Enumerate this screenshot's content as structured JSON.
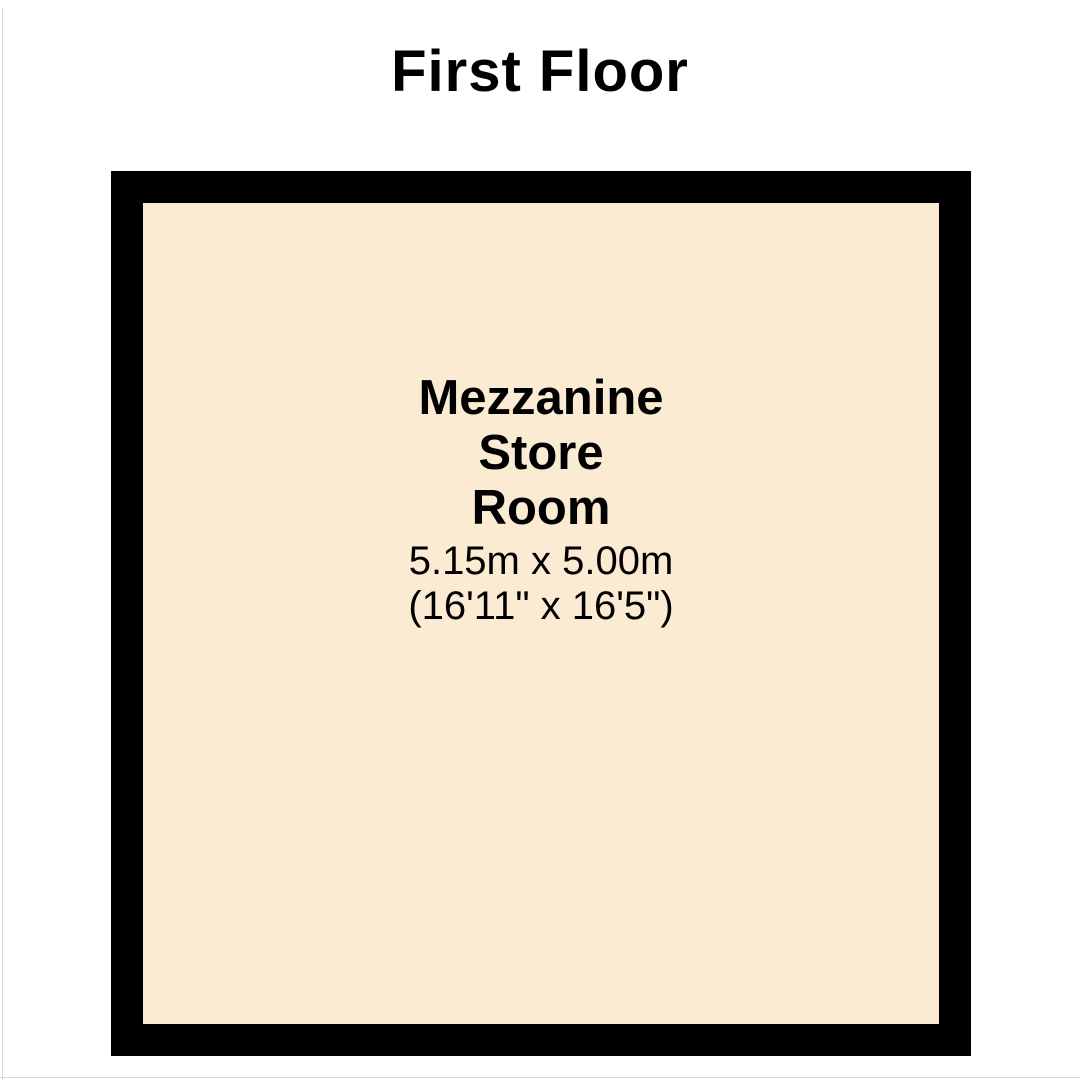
{
  "page": {
    "title": "First Floor"
  },
  "floorplan": {
    "room": {
      "name_line1": "Mezzanine",
      "name_line2": "Store",
      "name_line3": "Room",
      "dimensions_metric": "5.15m x 5.00m",
      "dimensions_imperial": "(16'11\" x 16'5\")",
      "fill_color": "#FCEBD3",
      "wall_color": "#000000",
      "text_color": "#000000"
    }
  }
}
